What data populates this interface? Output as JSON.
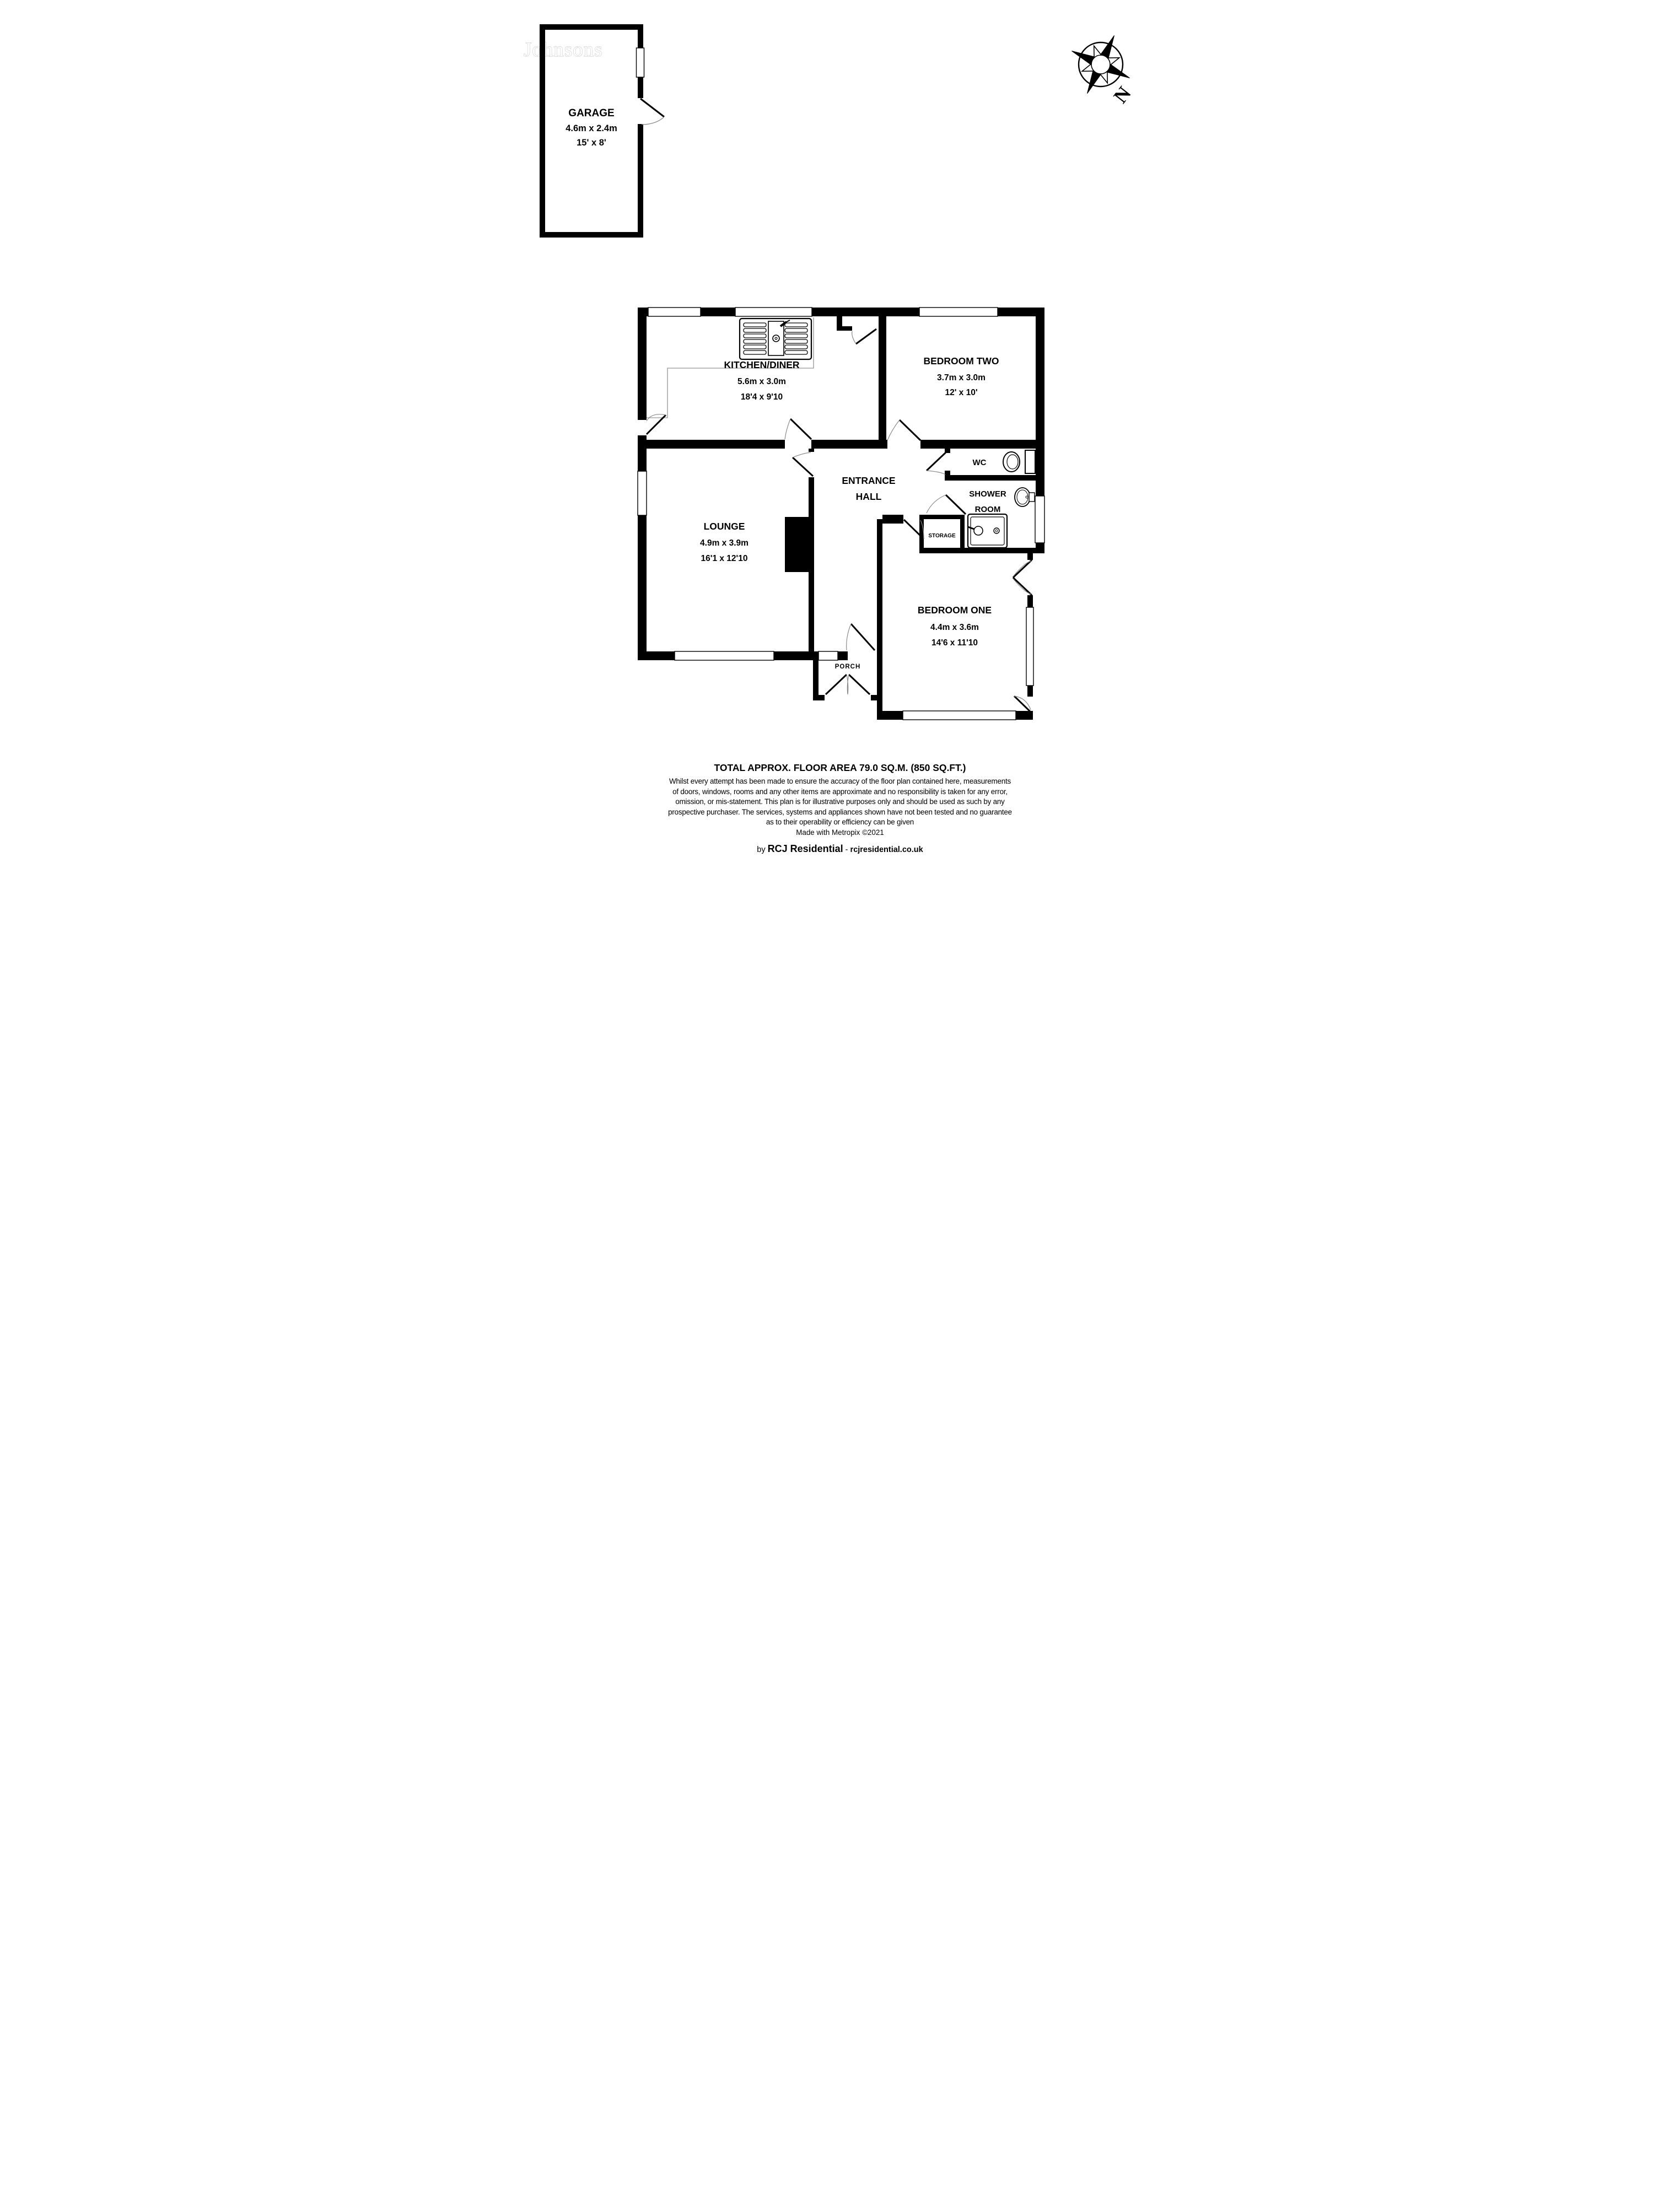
{
  "watermark": "Johnsons",
  "compass": {
    "north_label": "N"
  },
  "rooms": {
    "garage": {
      "name": "GARAGE",
      "dim_metric": "4.6m x 2.4m",
      "dim_imperial": "15' x 8'"
    },
    "kitchen": {
      "name": "KITCHEN/DINER",
      "dim_metric": "5.6m x 3.0m",
      "dim_imperial": "18'4 x 9'10"
    },
    "bedroom2": {
      "name": "BEDROOM TWO",
      "dim_metric": "3.7m x 3.0m",
      "dim_imperial": "12' x 10'"
    },
    "hall": {
      "line1": "ENTRANCE",
      "line2": "HALL"
    },
    "wc": {
      "name": "WC"
    },
    "shower": {
      "line1": "SHOWER",
      "line2": "ROOM"
    },
    "storage": {
      "name": "STORAGE"
    },
    "lounge": {
      "name": "LOUNGE",
      "dim_metric": "4.9m x 3.9m",
      "dim_imperial": "16'1 x 12'10"
    },
    "bedroom1": {
      "name": "BEDROOM ONE",
      "dim_metric": "4.4m x 3.6m",
      "dim_imperial": "14'6 x 11'10"
    },
    "porch": {
      "name": "PORCH"
    }
  },
  "footer": {
    "total_area": "TOTAL APPROX. FLOOR AREA 79.0 SQ.M. (850 SQ.FT.)",
    "disclaimer_lines": [
      "Whilst every attempt has been made to ensure the accuracy of the floor plan contained here, measurements",
      "of doors, windows, rooms and any other items are approximate and no responsibility is taken for any error,",
      "omission, or mis-statement. This plan is for illustrative purposes only and should be used as such by any",
      "prospective purchaser. The services, systems and appliances shown have not been tested and no guarantee",
      "as to their operability or efficiency can be given"
    ],
    "credit": "Made with Metropix ©2021",
    "byline_prefix": "by ",
    "byline_brand": "RCJ Residential",
    "byline_separator": " - ",
    "byline_site": "rcjresidential.co.uk"
  },
  "colors": {
    "wall": "#000000",
    "counter_outline": "#a8a8a8",
    "door_swing": "#8a8a8a",
    "watermark_outline": "#c2c2c2"
  }
}
